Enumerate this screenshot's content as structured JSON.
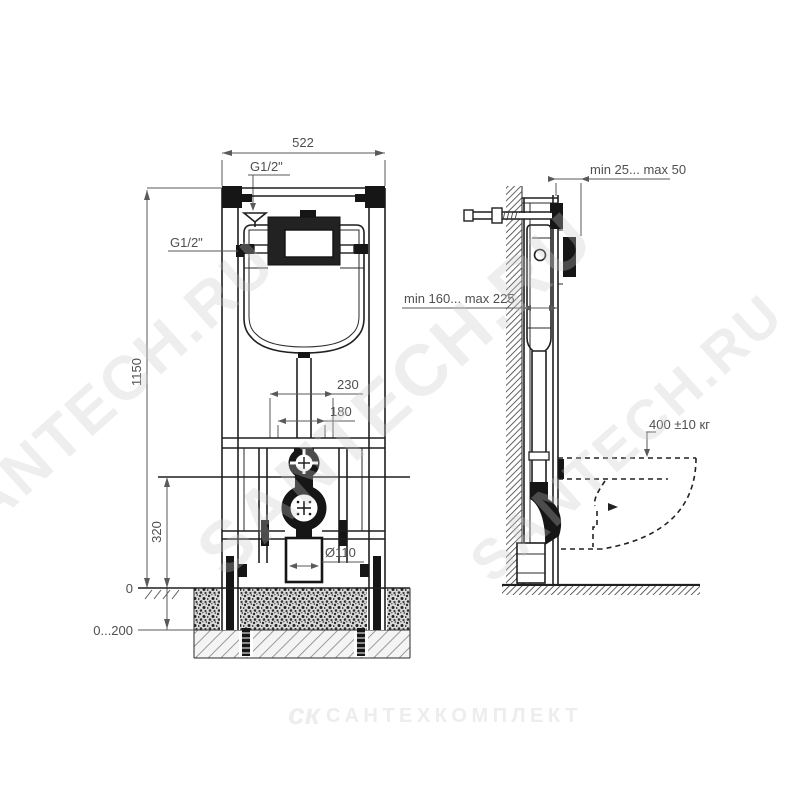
{
  "labels": {
    "front": {
      "width": "522",
      "inlet_top": "G1/2\"",
      "inlet_side": "G1/2\"",
      "height": "1150",
      "spacing_outer": "230",
      "spacing_inner": "180",
      "drain_height": "320",
      "zero": "0",
      "floor_range": "0...200",
      "drain_diameter": "Ø110"
    },
    "side": {
      "wall_clearance": "min 25... max 50",
      "frame_depth": "min 160... max 225",
      "load": "400 ±10 кг"
    },
    "watermarks": {
      "diagonal": "SANTECH.RU",
      "logo": "ск",
      "company": "САНТЕХКОМПЛЕКТ"
    }
  },
  "colors": {
    "background": "#ffffff",
    "line": "#1f1f1f",
    "dimension": "#5a5a5a",
    "watermark": "#d9d9d9"
  }
}
